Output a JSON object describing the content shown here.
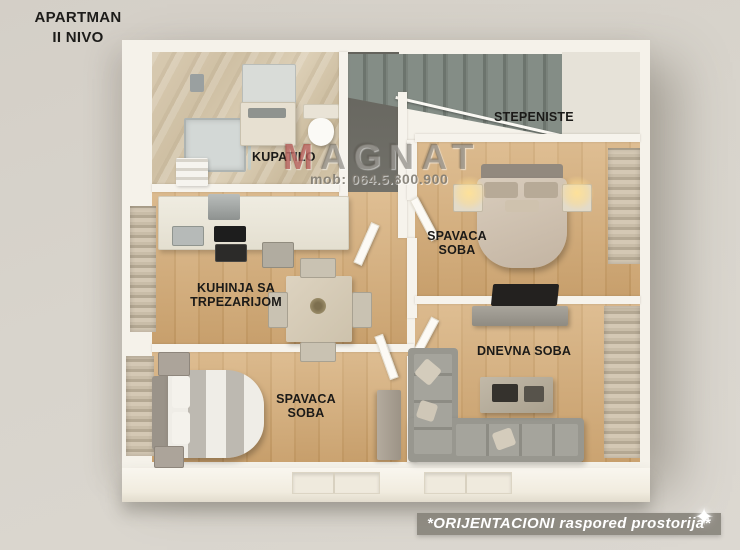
{
  "page": {
    "title": "APARTMAN\nII NIVO"
  },
  "watermark": {
    "brand": "MAGNAT",
    "phone": "mob: 064.5.800.900"
  },
  "rooms": {
    "kupatilo": {
      "label": "KUPATILO"
    },
    "stepeniste": {
      "label": "STEPENISTE"
    },
    "spavaca_soba_gornja": {
      "label": "SPAVACA\nSOBA"
    },
    "kuhinja": {
      "label": "KUHINJA SA\nTRPEZARIJOM"
    },
    "dnevna_soba": {
      "label": "DNEVNA SOBA"
    },
    "spavaca_soba_donja": {
      "label": "SPAVACA\nSOBA"
    }
  },
  "footer": {
    "note": "*ORIJENTACIONI raspored prostorija*"
  },
  "icons": {
    "sparkle": "✦"
  },
  "colors": {
    "background": "#d6d1c9",
    "brand_accent_red": "#aa3734",
    "watermark_grey": "#6e6a62",
    "note_band_grey": "#84817a",
    "label_text": "#1b1a18",
    "wood_floor": "#cda26e",
    "marble_floor": "#d2c4aa",
    "stair_floor": "#6e6d66",
    "wall_white": "#f5f2ea"
  }
}
